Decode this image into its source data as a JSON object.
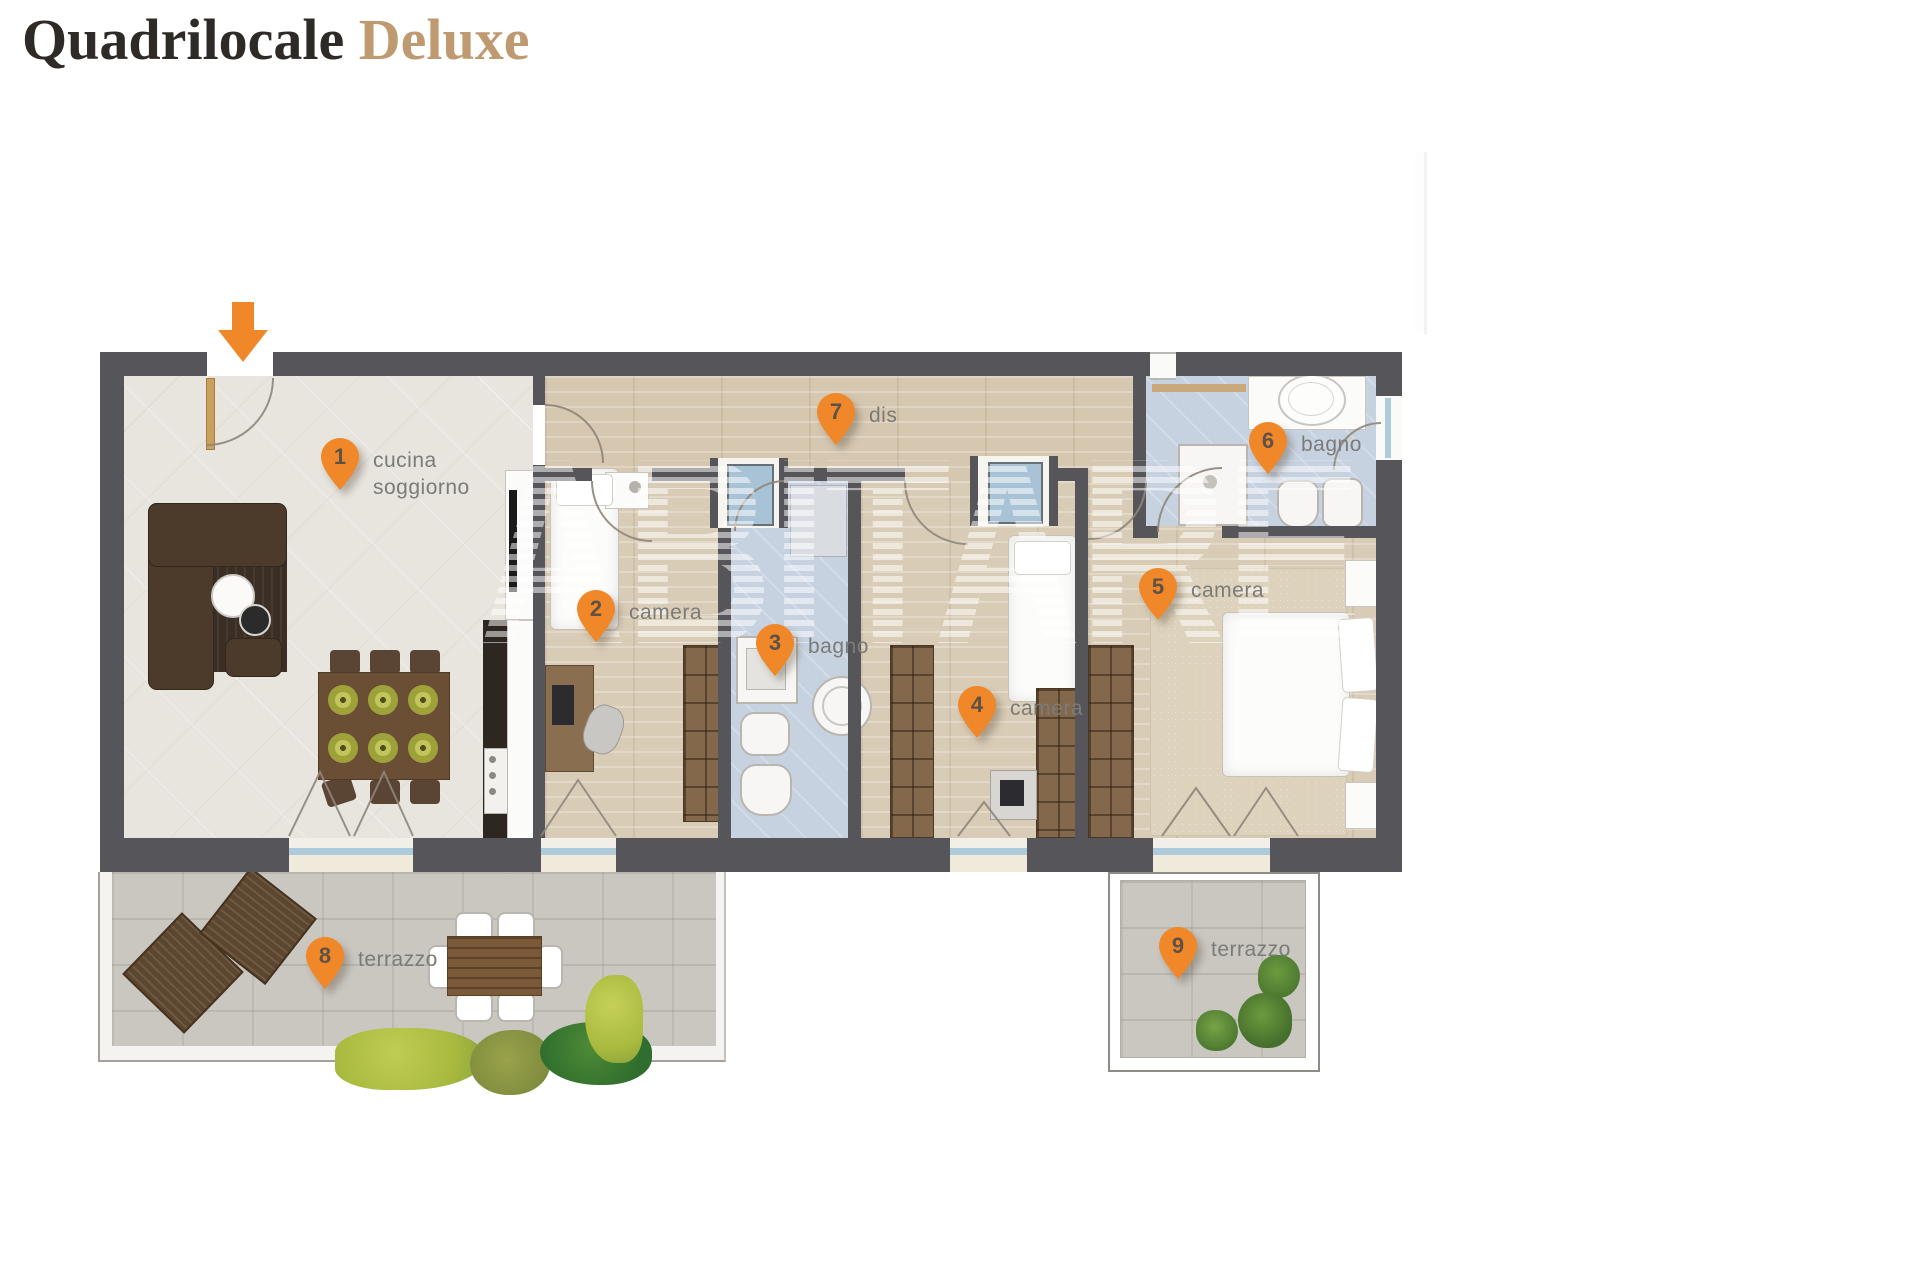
{
  "title": {
    "main": "Quadrilocale",
    "accent": "Deluxe"
  },
  "watermark": "ABITARE",
  "markers": [
    {
      "num": "1",
      "label": "cucina\nsoggiorno"
    },
    {
      "num": "2",
      "label": "camera"
    },
    {
      "num": "3",
      "label": "bagno"
    },
    {
      "num": "4",
      "label": "camera"
    },
    {
      "num": "5",
      "label": "camera"
    },
    {
      "num": "6",
      "label": "bagno"
    },
    {
      "num": "7",
      "label": "dis"
    },
    {
      "num": "8",
      "label": "terrazzo"
    },
    {
      "num": "9",
      "label": "terrazzo"
    }
  ],
  "icons": {
    "marker": "location-pin",
    "entrance": "down-arrow"
  },
  "colors": {
    "marker_orange": "#F0882A",
    "title_text": "#2E2A26",
    "title_accent": "#BF9A71",
    "wall": "#56565A",
    "label_gray": "#7B7B78",
    "bath_floor": "#C7D2E1",
    "wood_floor": "#D9CCB7",
    "tile_floor": "#E8E5DF",
    "terrace_floor": "#CAC7C1"
  }
}
